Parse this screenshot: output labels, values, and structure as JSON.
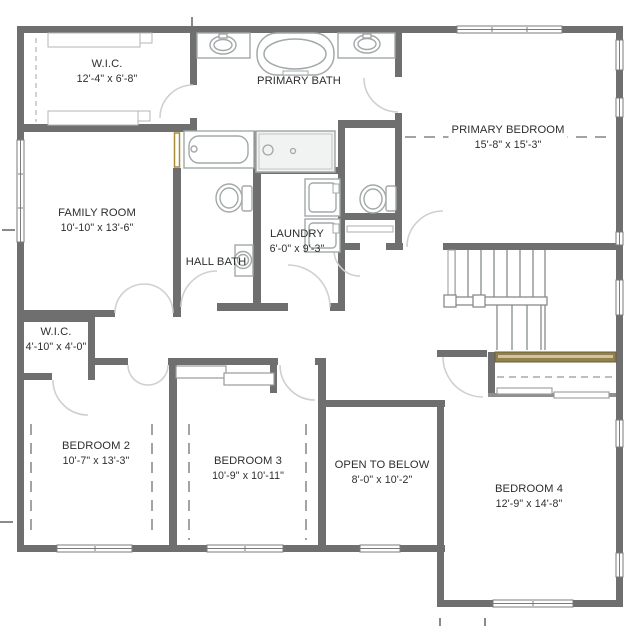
{
  "plan": {
    "title": "Second floor plan",
    "colors": {
      "wall": "#6f6f6f",
      "fixture_line": "#a3a8a8",
      "door_arc": "#cdd1d1",
      "wood_shelf": "#93804e",
      "pocket_door_gold": "#a98b35",
      "label_text": "#2e2e2e"
    },
    "rooms": [
      {
        "id": "wic-primary",
        "name": "W.I.C.",
        "dims": "12'-4\" x 6'-8\""
      },
      {
        "id": "primary-bath",
        "name": "PRIMARY BATH"
      },
      {
        "id": "primary-bedroom",
        "name": "PRIMARY BEDROOM",
        "dims": "15'-8\" x 15'-3\""
      },
      {
        "id": "family-room",
        "name": "FAMILY ROOM",
        "dims": "10'-10\" x 13'-6\""
      },
      {
        "id": "hall-bath",
        "name": "HALL BATH"
      },
      {
        "id": "laundry",
        "name": "LAUNDRY",
        "dims": "6'-0\" x 9'-3\""
      },
      {
        "id": "wic-2",
        "name": "W.I.C.",
        "dims": "4'-10\" x 4'-0\""
      },
      {
        "id": "bedroom-2",
        "name": "BEDROOM 2",
        "dims": "10'-7\" x 13'-3\""
      },
      {
        "id": "bedroom-3",
        "name": "BEDROOM 3",
        "dims": "10'-9\" x 10'-11\""
      },
      {
        "id": "open-to-below",
        "name": "OPEN TO BELOW",
        "dims": "8'-0\" x 10'-2\""
      },
      {
        "id": "bedroom-4",
        "name": "BEDROOM 4",
        "dims": "12'-9\" x 14'-8\""
      }
    ],
    "fixtures": [
      "freestanding-tub",
      "vanity-sink",
      "bathtub",
      "shower",
      "toilet",
      "pedestal-sink",
      "washer",
      "dryer",
      "stairs",
      "closet-rod",
      "closet-shelf",
      "window",
      "door-swing"
    ]
  }
}
